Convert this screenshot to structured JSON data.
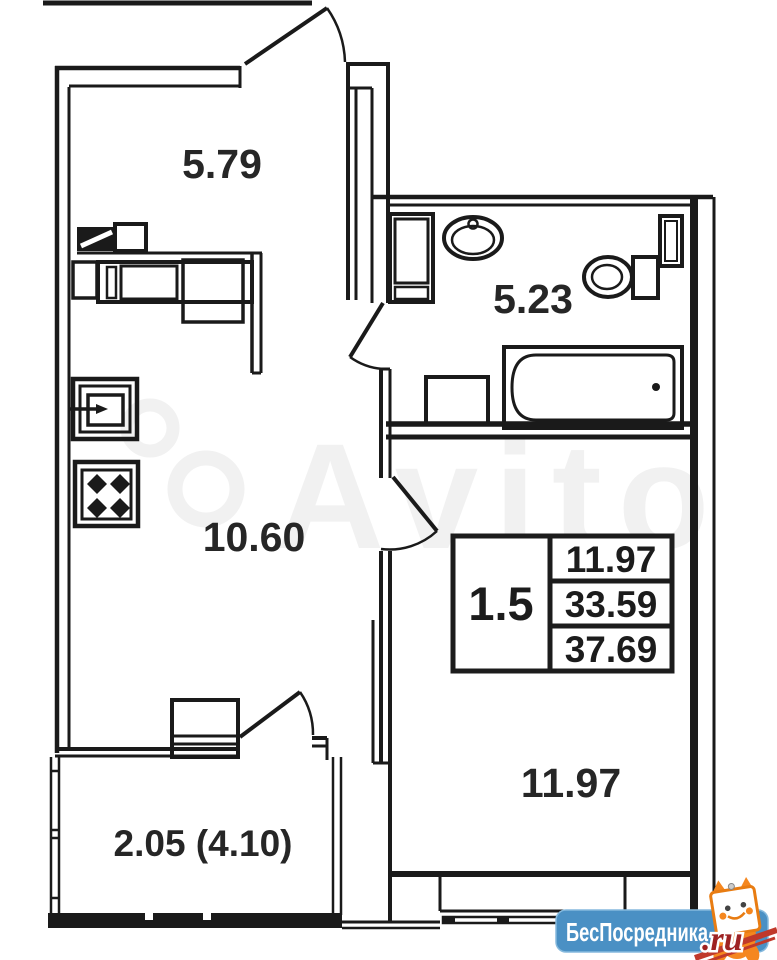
{
  "rooms": [
    {
      "id": "hall-top",
      "label": "5.79"
    },
    {
      "id": "bathroom",
      "label": "5.23"
    },
    {
      "id": "kitchen-living",
      "label": "10.60"
    },
    {
      "id": "bedroom",
      "label": "11.97"
    },
    {
      "id": "balcony",
      "label": "2.05 (4.10)"
    }
  ],
  "area_table": {
    "rooms_count": "1.5",
    "living_area": "11.97",
    "total_area": "33.59",
    "total_with_balcony": "37.69"
  },
  "watermark": {
    "text": "Avito"
  },
  "logo": {
    "name": "БесПосредника",
    "domain": ".ru"
  },
  "colors": {
    "wall": "#1a1a1a",
    "wm": "#f1f1f1",
    "logo_blue": "#4a90c4",
    "logo_red": "#9e2222",
    "mascot_orange": "#f5871f"
  }
}
